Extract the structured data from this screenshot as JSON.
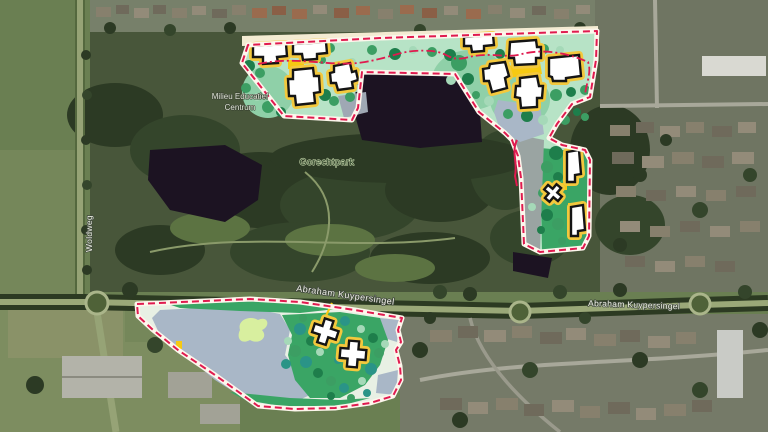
{
  "map_labels": {
    "poi_milieu_line1": "Milieu Educatief",
    "poi_milieu_line2": "Centrum",
    "park_name": "Gorechtpark",
    "road_woldweg": "Woldweg",
    "road_abraham_center": "Abraham Kuypersingel",
    "road_abraham_east": "Abraham Kuypersingel"
  },
  "colors": {
    "plan_mint": "#b7e3c6",
    "plan_green": "#3aa565",
    "plan_green_light": "#8fd0a8",
    "tree_dark": "#1e7e4b",
    "tree_medium": "#3c9e63",
    "tree_light": "#a5d9b8",
    "tree_teal": "#2a9487",
    "building_fill": "#ffffff",
    "building_outline": "#141414",
    "building_halo": "#f3c83d",
    "plaza_yellow": "#f6c912",
    "boundary_red": "#e01a4f",
    "boundary_casing": "#fdf6ec",
    "water_plan": "#a9b7c7",
    "pond_dark": "#1c1322",
    "path_cream": "#f3ebd2",
    "satellite_field": "#6d8150"
  }
}
